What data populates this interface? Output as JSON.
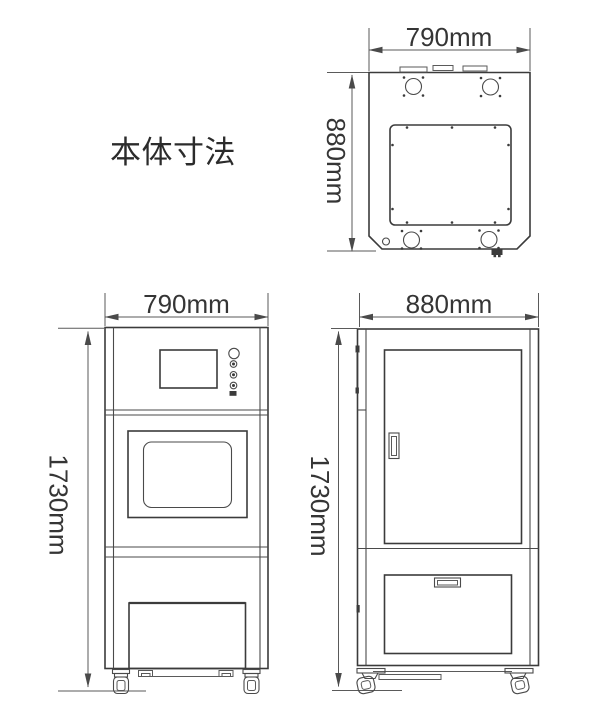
{
  "title": "本体寸法",
  "views": {
    "top": {
      "label": "top-view",
      "width_label": "790mm",
      "depth_label": "880mm"
    },
    "front": {
      "label": "front-view",
      "width_label": "790mm",
      "height_label": "1730mm"
    },
    "side": {
      "label": "side-view",
      "width_label": "880mm",
      "height_label": "1730mm"
    }
  },
  "colors": {
    "outline": "#3b3b3b",
    "dimension_line": "#595959",
    "text": "#2d2d2d",
    "background": "#ffffff"
  }
}
